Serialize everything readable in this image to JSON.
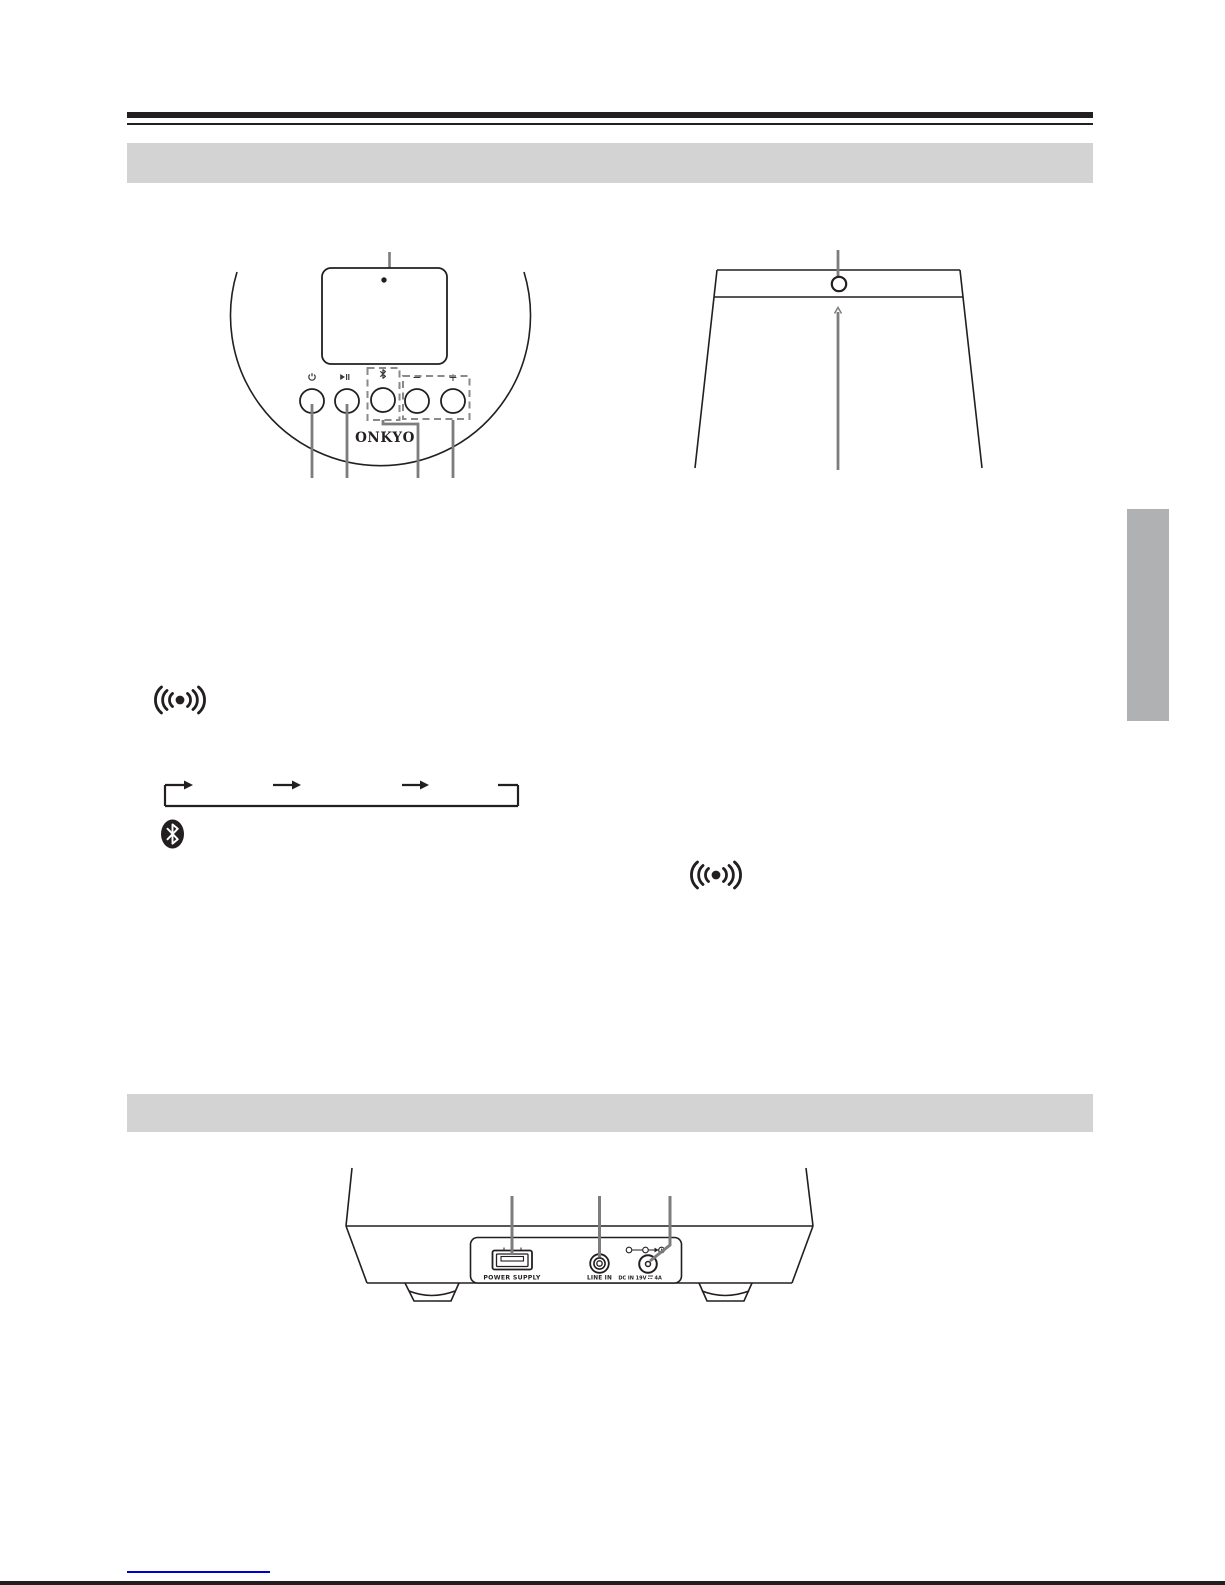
{
  "page": {
    "background": "#ffffff"
  },
  "colors": {
    "line_art": "#231f20",
    "pointer_gray": "#7d7d7d",
    "dashed_outline_gray": "#8a8a8a",
    "banner_gray": "#d3d3d3",
    "side_tab_gray": "#b0b1b3",
    "link_blue": "#0000cc"
  },
  "front_panel": {
    "brand_logo": "ONKYO",
    "volume_down_label": "−",
    "volume_up_label": "+",
    "icons": {
      "power": "power-standby symbol",
      "play_pause": "play/pause symbol",
      "bluetooth": "bluetooth rune",
      "volume_down": "−",
      "volume_up": "+"
    }
  },
  "top_panel": {
    "icons": {
      "power_hole": "small circular opening"
    }
  },
  "body_icons": {
    "wireless": "((•)) wireless wave mark",
    "bluetooth_badge": "black oval bluetooth mark",
    "cycle_arrows": "loop diagram with right arrows and return line"
  },
  "rear_panel": {
    "usb_port_label": "POWER SUPPLY",
    "line_in_label": "LINE IN",
    "dc_in_label": "DC IN 19V ⎓ 4A",
    "dc_in_label_left": "DC IN 19V",
    "dc_in_label_right": "4A",
    "icons": {
      "polarity": "center-positive polarity symbol"
    }
  }
}
